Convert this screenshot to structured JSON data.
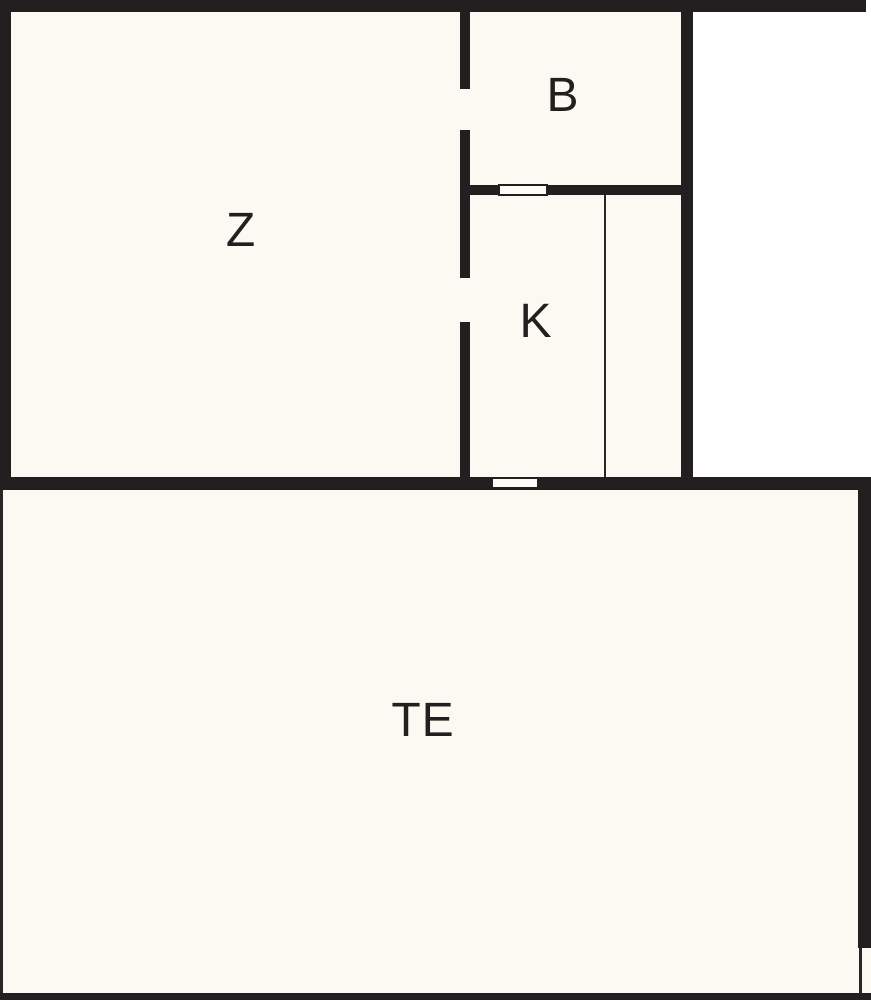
{
  "floorplan": {
    "title": "apartment-floor-plan",
    "colors": {
      "wall": "#231f20",
      "floor": "#fbfaf2",
      "outside": "#ffffff",
      "label_text": "#231f20"
    },
    "rooms": [
      {
        "id": "z",
        "label": "Z"
      },
      {
        "id": "b",
        "label": "B"
      },
      {
        "id": "k",
        "label": "K"
      },
      {
        "id": "te",
        "label": "TE"
      }
    ]
  }
}
